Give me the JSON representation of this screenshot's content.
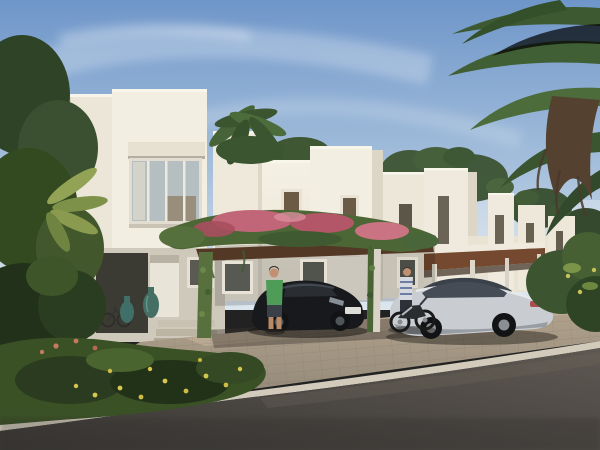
{
  "scene": {
    "kind": "architectural-rendering",
    "subject": "row of modern white townhouses with flowering pergola carport, parked cars and tropical landscaping",
    "objects": [
      "sky",
      "wispy-clouds",
      "date-palm-canopy",
      "distant-townhouse-row",
      "main-villa",
      "upper-picture-window",
      "roof-terrace-trees",
      "flowering-pergola-carport",
      "bougainvillea",
      "vine-covered-posts",
      "black-sedan",
      "silver-coupe",
      "motorcycle",
      "rider-in-striped-shirt",
      "man-in-green-shirt",
      "teal-garden-vases",
      "entry-door",
      "entry-steps",
      "ground-floor-windows",
      "flower-bed",
      "yellow-flowers",
      "paver-driveway",
      "stone-curb",
      "asphalt-road",
      "left-tropical-foliage",
      "right-foreground-bush",
      "bicycle"
    ]
  },
  "palette": {
    "sky_top": "#6F96C9",
    "sky_mid": "#A6C0DC",
    "sky_horizon": "#DCE6EE",
    "cloud": "#FFFFFF",
    "haze": "#E8EEF2",
    "wall_light": "#F2EEE1",
    "wall_mid": "#E9E4D5",
    "wall_shade": "#DCD6C6",
    "wall_dark": "#CBC5B5",
    "coping": "#F8F5EA",
    "lintel": "#E7E1D1",
    "glass": "#B5BEC1",
    "glass_dark": "#565A52",
    "window_warm": "#C49A58",
    "curtain": "#DCD8CB",
    "wood_canopy": "#75492F",
    "wood_dark": "#543826",
    "vine_green": "#4C6735",
    "vine_dark": "#35512A",
    "vine_light": "#5F7C42",
    "bougainvillea": "#C16678",
    "bougainvillea_dark": "#A84E60",
    "bougainvillea_light": "#D88E9C",
    "palm_dark": "#3C5931",
    "palm_mid": "#4C6C3C",
    "palm_skirt": "#54412F",
    "foliage_dark": "#22311A",
    "foliage_mid": "#3A5126",
    "foliage_light": "#93A355",
    "flower_yellow": "#D8C74E",
    "flower_salmon": "#C67A5C",
    "paver_light": "#B5A68F",
    "paver_dark": "#8B8173",
    "paver_sun": "#C4B299",
    "curb": "#D2CBBB",
    "asphalt_light": "#5E5852",
    "asphalt_dark": "#393734",
    "car_black": "#17191C",
    "car_black_hl": "#41464C",
    "car_silver": "#C9CDD2",
    "car_silver_hl": "#E8EAEC",
    "car_silver_shade": "#979DA3",
    "car_glass": "#3A4149",
    "taillight": "#A85050",
    "tire": "#121314",
    "rim": "#8A8F94",
    "plate": "#DEDED8",
    "shirt_green": "#4F9B58",
    "shorts": "#3A4047",
    "skin": "#C29070",
    "shirt_striped": "#D6D9DD",
    "stripe_blue": "#4A5F93",
    "vase_teal": "#3F6F66",
    "step_stone": "#C9C2B2",
    "shadow": "#1C1A16"
  }
}
